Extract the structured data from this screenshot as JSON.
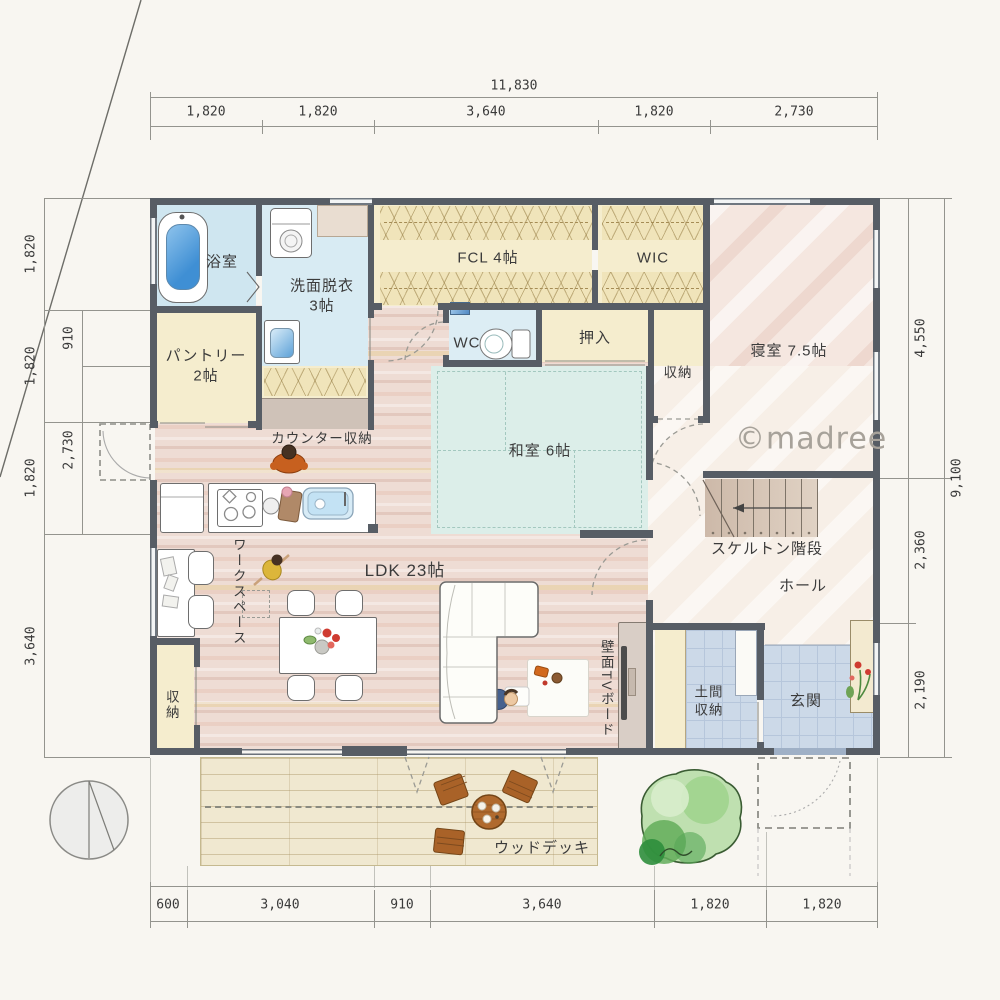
{
  "meta": {
    "watermark": "©madree"
  },
  "dims": {
    "top": {
      "total": "11,830",
      "segments": [
        "1,820",
        "1,820",
        "3,640",
        "1,820",
        "2,730"
      ]
    },
    "left": {
      "outer": [
        "1,820",
        "1,820",
        "1,820",
        "3,640"
      ],
      "inner": [
        "910",
        "2,730"
      ]
    },
    "right": {
      "total": "9,100",
      "inner": [
        "4,550",
        "2,360",
        "2,190"
      ]
    },
    "bottom": {
      "segments": [
        "600",
        "3,040",
        "910",
        "3,640",
        "1,820",
        "1,820"
      ]
    }
  },
  "rooms": {
    "bath": "浴室",
    "washroom": "洗面脱衣\n3帖",
    "pantry": "パントリー\n2帖",
    "counter_storage": "カウンター収納",
    "fcl": "FCL 4帖",
    "wic": "WIC",
    "wc": "WC",
    "oshiire": "押入",
    "storage_north": "収納",
    "bedroom": "寝室 7.5帖",
    "washitsu": "和室 6帖",
    "stairs": "スケルトン階段",
    "hall": "ホール",
    "ldk": "LDK 23帖",
    "workspace": "ワークスペース",
    "tv_board": "壁面TVボード",
    "doma": "土間\n収納",
    "genkan": "玄関",
    "storage_sw": "収納",
    "deck": "ウッドデッキ"
  },
  "colors": {
    "wall": "#575d65",
    "wood_floor": "#eedcd4",
    "tatami": "#dceee9",
    "wet_floor": "#d8ebf3",
    "closet": "#f5edce",
    "tile": "#ccd9e8",
    "deck": "#f0e8d0",
    "tree": "#63ad5a",
    "bath_water": "#4f9fd8"
  }
}
